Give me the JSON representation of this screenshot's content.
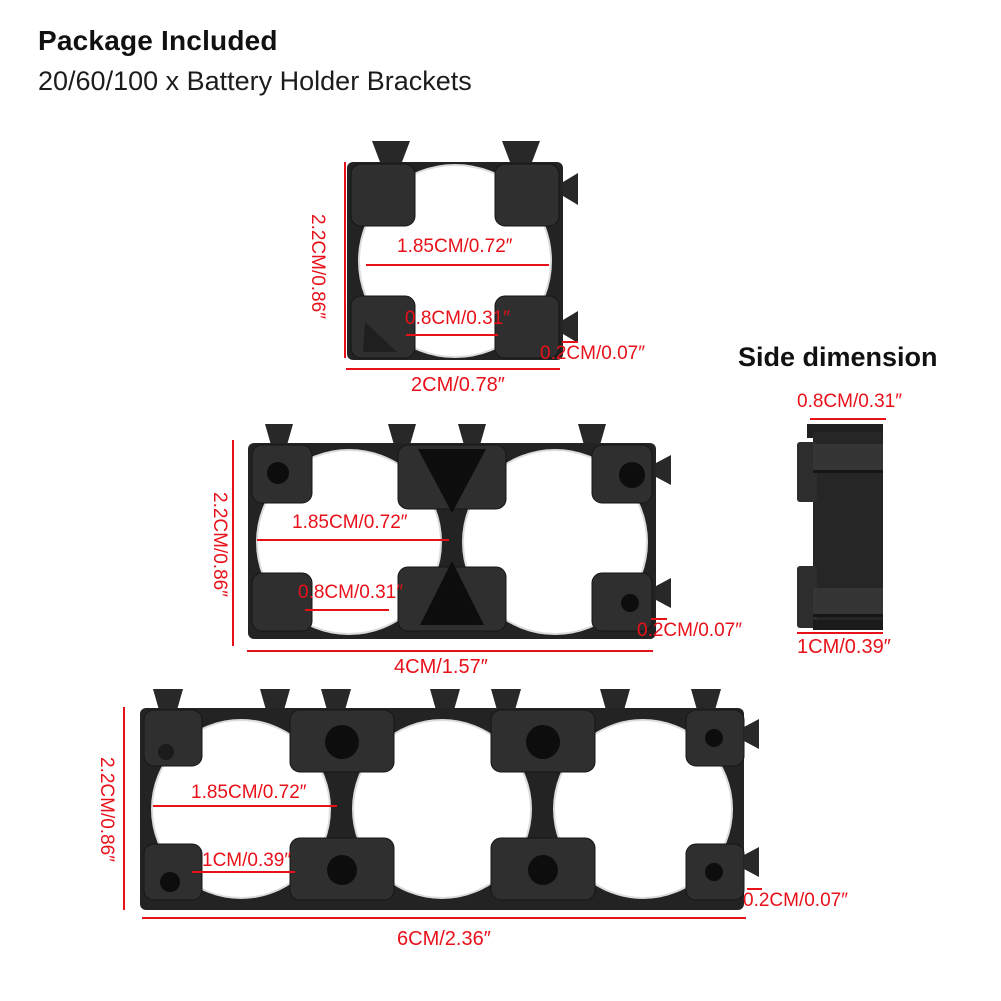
{
  "header": {
    "title": "Package Included",
    "subtitle": "20/60/100 x Battery Holder Brackets"
  },
  "side_view": {
    "title": "Side dimension",
    "width_top": "0.8CM/0.31″",
    "width_bottom": "1CM/0.39″"
  },
  "brackets": {
    "single": {
      "height": "2.2CM/0.86″",
      "hole": "1.85CM/0.72″",
      "pad": "0.8CM/0.31″",
      "rib": "0.2CM/0.07″",
      "width": "2CM/0.78″"
    },
    "double": {
      "height": "2.2CM/0.86″",
      "hole": "1.85CM/0.72″",
      "pad": "0.8CM/0.31″",
      "rib": "0.2CM/0.07″",
      "width": "4CM/1.57″"
    },
    "triple": {
      "height": "2.2CM/0.86″",
      "hole": "1.85CM/0.72″",
      "pad": "1CM/0.39″",
      "rib": "0.2CM/0.07″",
      "width": "6CM/2.36″"
    }
  },
  "colors": {
    "dimension_red": "#e8111a",
    "plastic_dark": "#232323",
    "pad_gray": "#2f2f2f",
    "hole_black": "#0d0d0d",
    "background": "#ffffff",
    "text_black": "#111111"
  }
}
